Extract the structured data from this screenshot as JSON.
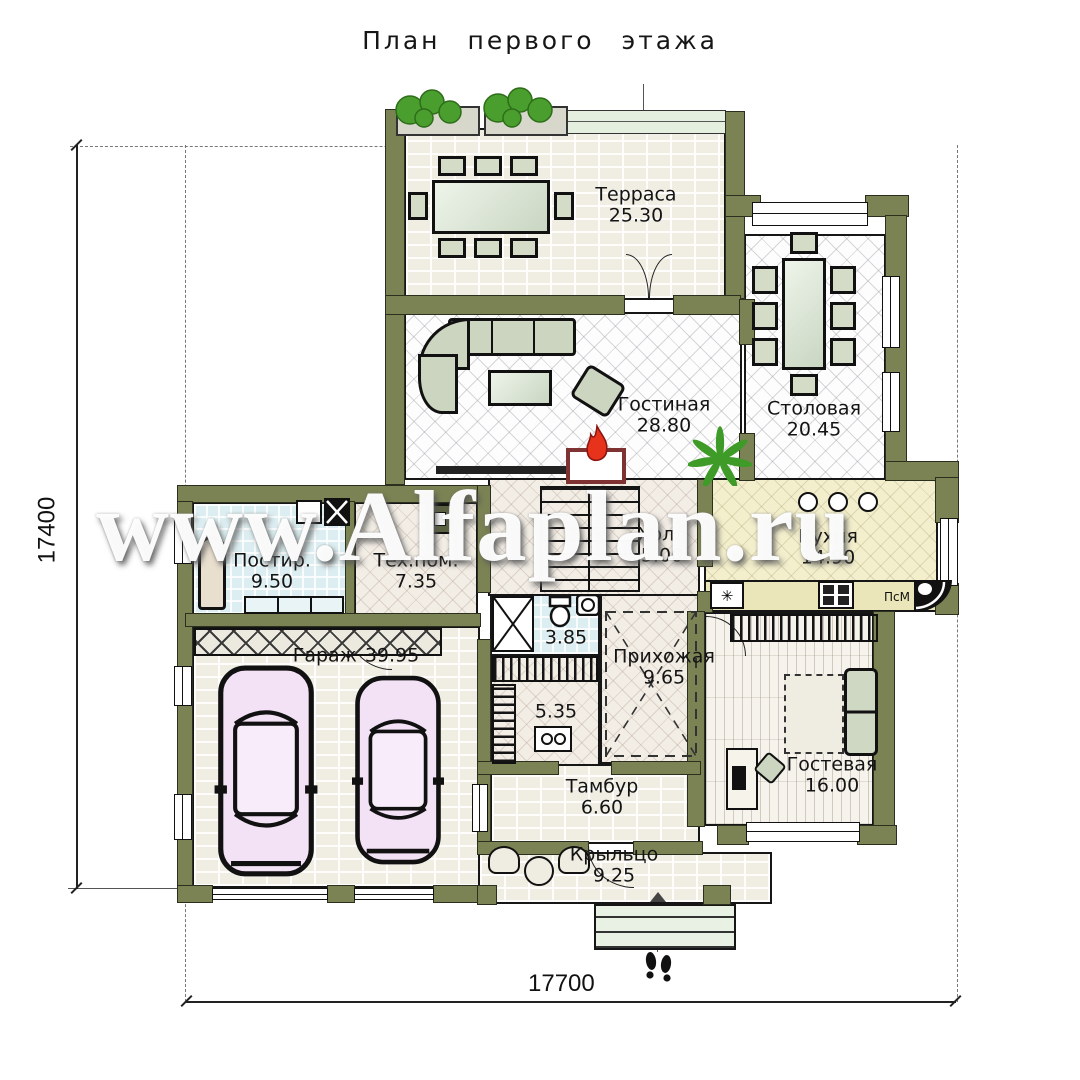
{
  "title": "План первого этажа",
  "watermark": "www.Alfaplan.ru",
  "dimensions": {
    "side": "17400",
    "bottom": "17700"
  },
  "rooms": {
    "terrace": {
      "name": "Терраса",
      "area": "25.30"
    },
    "living": {
      "name": "Гостиная",
      "area": "28.80"
    },
    "dining": {
      "name": "Столовая",
      "area": "20.45"
    },
    "kitchen": {
      "name": "Кухня",
      "area": "14.90"
    },
    "hall": {
      "name": "Холл",
      "area": "5.00"
    },
    "laundry": {
      "name": "Постир.",
      "area": "9.50"
    },
    "tech": {
      "name": "Тех.пом.",
      "area": "7.35"
    },
    "garage": {
      "name": "Гараж",
      "area": "39.95"
    },
    "bathroom": {
      "name": "",
      "area": "3.85"
    },
    "entry": {
      "name": "Прихожая",
      "area": "9.65"
    },
    "sauna": {
      "name": "",
      "area": "5.35"
    },
    "tambour": {
      "name": "Тамбур",
      "area": "6.60"
    },
    "guest": {
      "name": "Гостевая",
      "area": "16.00"
    },
    "porch": {
      "name": "Крыльцо",
      "area": "9.25"
    }
  },
  "appliances": {
    "dishwasher": "ПсМ",
    "freezer_glyph": "✳"
  },
  "colors": {
    "wall": "#7b8354",
    "flame": "#e7321c",
    "car": "#f3e2f5",
    "kitchen_floor": "#f3efcd",
    "laundry_floor": "#dceef1"
  }
}
